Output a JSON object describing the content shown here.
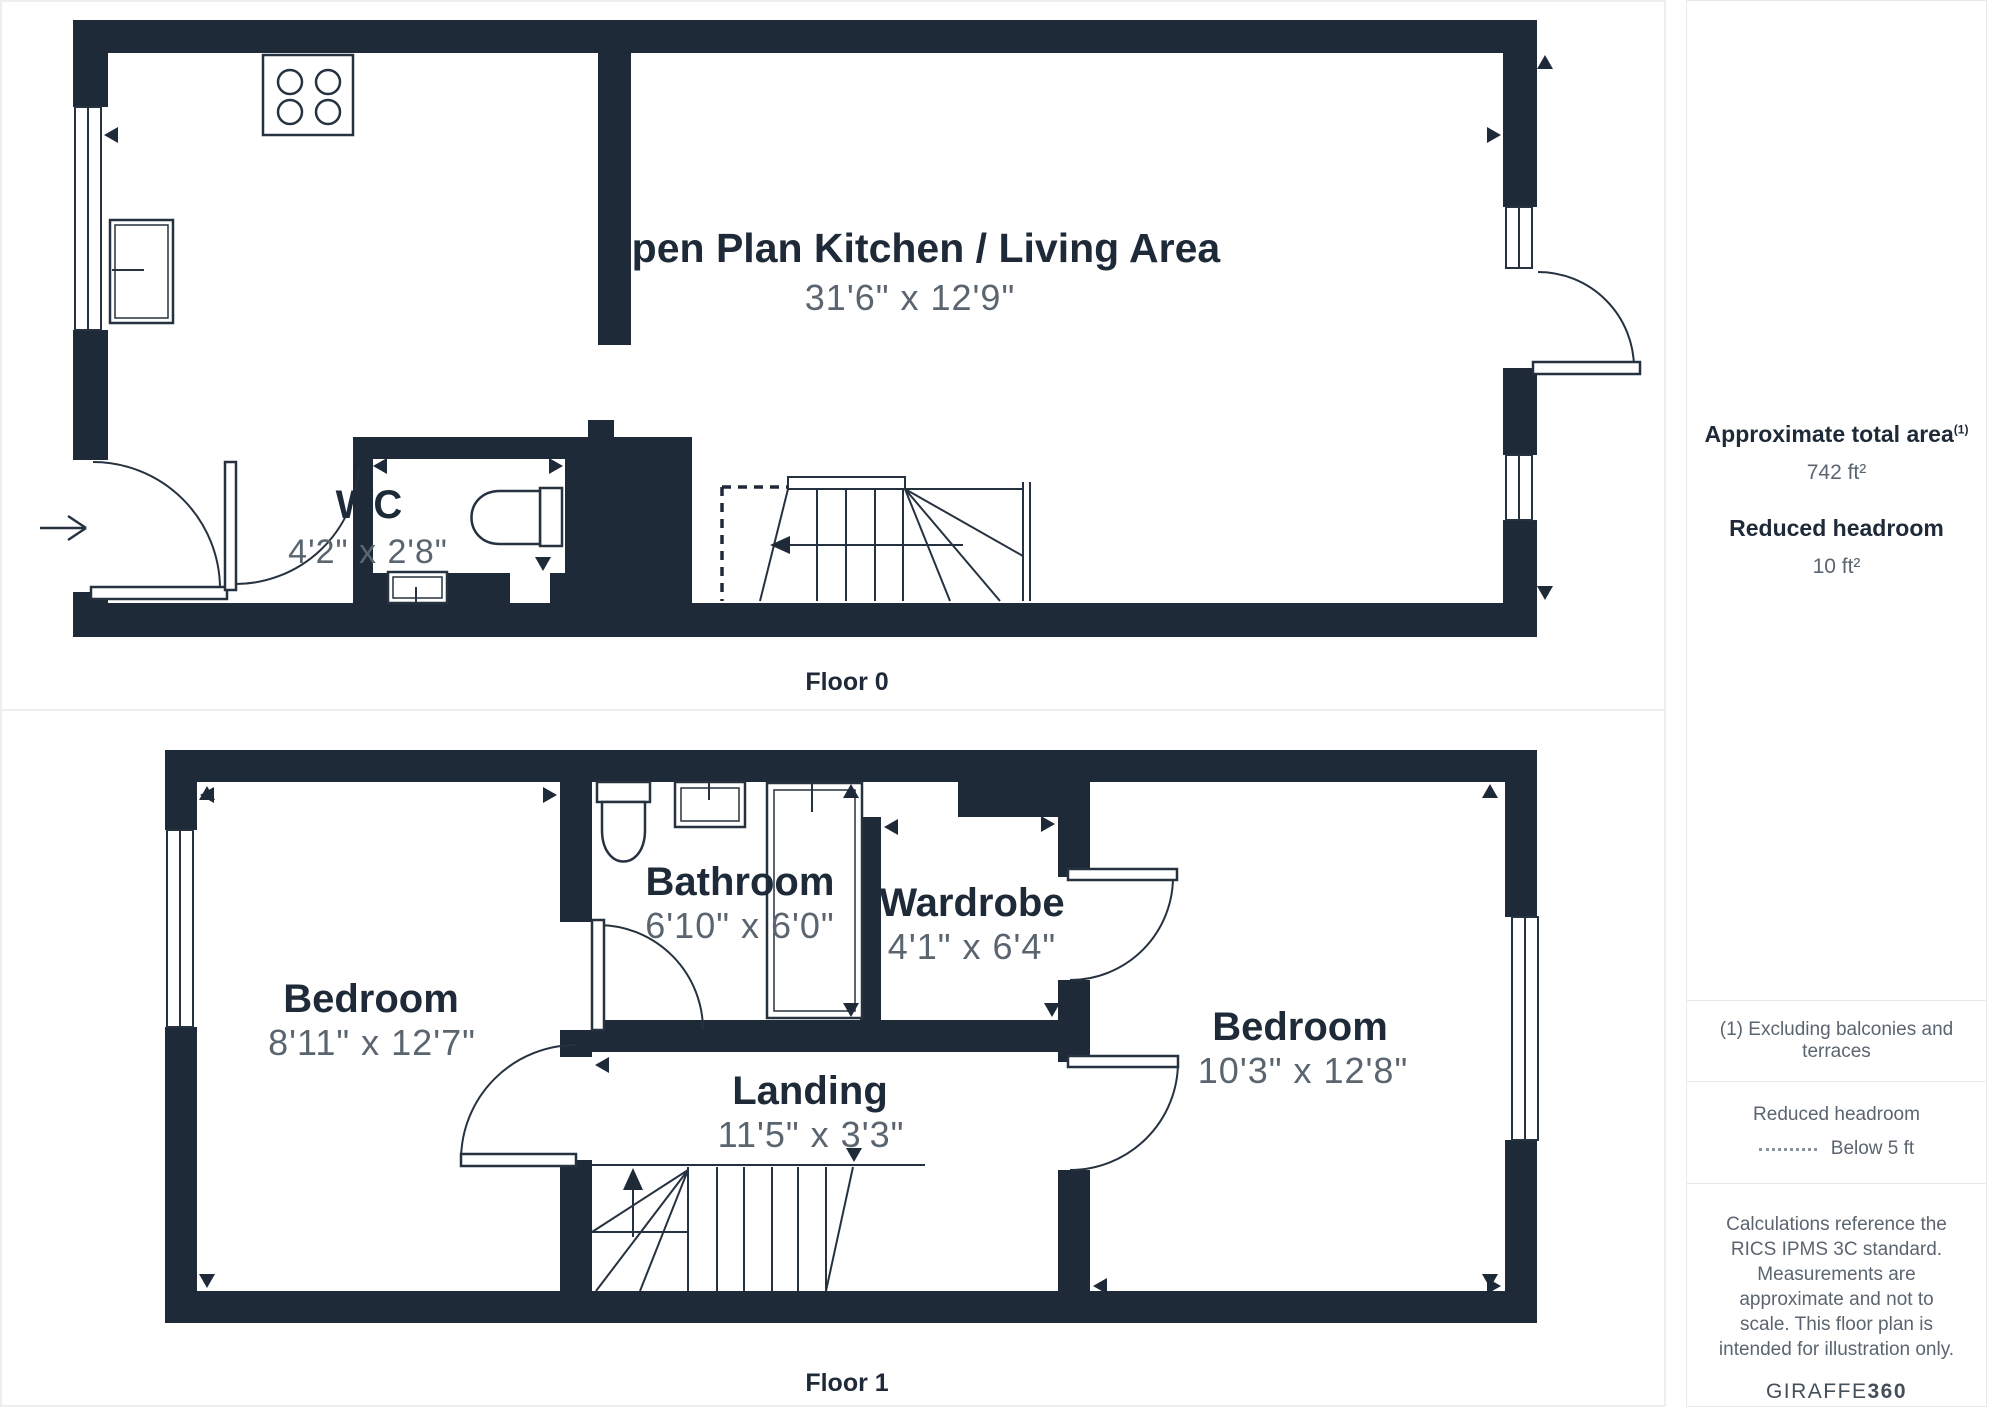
{
  "floor0": {
    "label": "Floor 0",
    "rooms": [
      {
        "name": "Open Plan Kitchen / Living Area",
        "dims": "31'6\" x 12'9\""
      },
      {
        "name": "WC",
        "dims": "4'2\" x 2'8\""
      }
    ]
  },
  "floor1": {
    "label": "Floor 1",
    "rooms": [
      {
        "name": "Bedroom",
        "dims": "8'11\" x 12'7\""
      },
      {
        "name": "Bathroom",
        "dims": "6'10\" x 6'0\""
      },
      {
        "name": "Wardrobe",
        "dims": "4'1\" x 6'4\""
      },
      {
        "name": "Landing",
        "dims": "11'5\" x 3'3\""
      },
      {
        "name": "Bedroom",
        "dims": "10'3\" x 12'8\""
      }
    ]
  },
  "sidebar": {
    "total_area_label": "Approximate total area",
    "total_area_note_ref": "(1)",
    "total_area_value": "742 ft²",
    "reduced_headroom_label": "Reduced headroom",
    "reduced_headroom_value": "10 ft²",
    "footnote": "(1) Excluding balconies and terraces",
    "legend_label": "Reduced headroom",
    "legend_value": "Below 5 ft",
    "disclaimer": "Calculations reference the RICS IPMS 3C standard. Measurements are approximate and not to scale. This floor plan is intended for illustration only.",
    "brand_name": "GIRAFFE",
    "brand_suffix": "360"
  },
  "colors": {
    "wall": "#1e2a38",
    "dim_text": "#5b6570",
    "line": "#26323f",
    "border": "#e8eaec"
  }
}
